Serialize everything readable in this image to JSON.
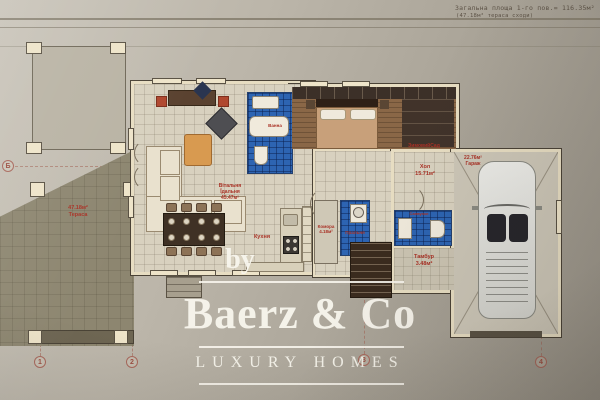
{
  "photo": {
    "note_line1": "Загальна площа 1-го пов.= 116.35м²",
    "note_line2": "(47.18м² тераса сходи)"
  },
  "watermark": {
    "by": "by",
    "brand": "Baerz & Co",
    "tagline": "LUXURY HOMES"
  },
  "plan": {
    "living": {
      "name1": "Вітальня",
      "name2": "Їдальня",
      "area": "45.47м²"
    },
    "kitchen": {
      "name": "Кухня"
    },
    "pantry": {
      "name": "Комора",
      "area": "4.18м²"
    },
    "laundry": {
      "name": "Пральня"
    },
    "bath": {
      "name": "Ванна"
    },
    "hall": {
      "name": "Хол",
      "area": "15.71м²"
    },
    "winter_garden": {
      "name": "ЗимовийСад"
    },
    "garage": {
      "area": "22.76м²",
      "name": "Гараж"
    },
    "wc": {
      "name": "Санвузол"
    },
    "vestibule": {
      "name": "Тамбур",
      "area": "3.48м²"
    },
    "terrace": {
      "area": "47.18м²",
      "name": "Тераса"
    }
  },
  "grid": {
    "columns": [
      "1",
      "2",
      "3",
      "4"
    ],
    "row": "Б"
  },
  "colors": {
    "label_red": "#a93226",
    "blue_tile": "#2d64b2",
    "watermark": "#f7f4ec"
  }
}
